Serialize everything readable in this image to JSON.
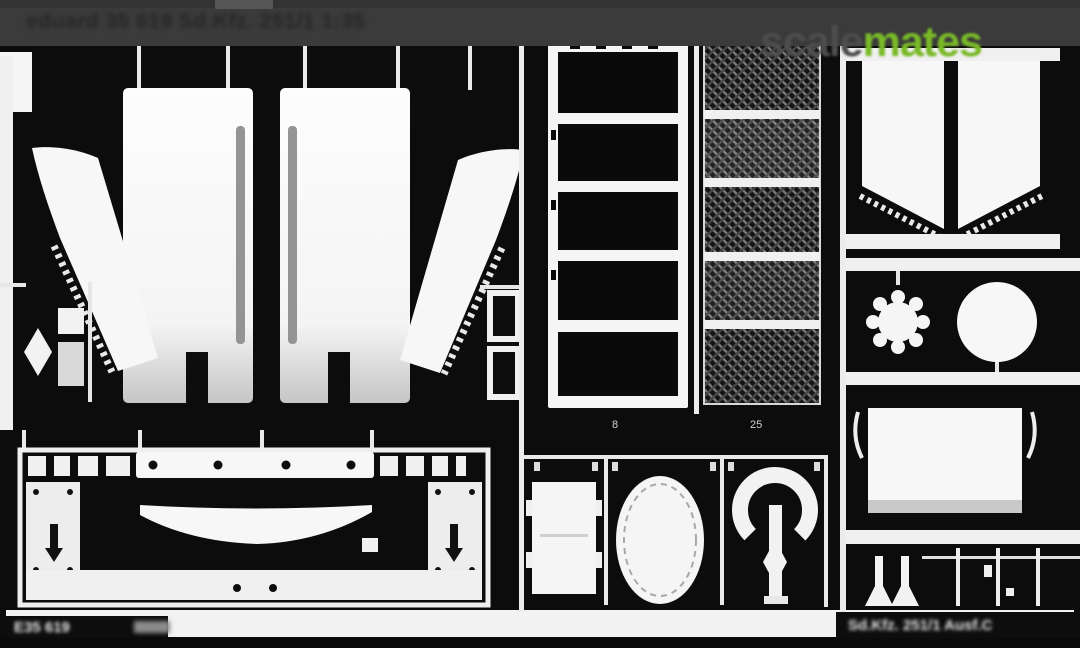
{
  "image_type": "scan of a photo-etched model detail fret on black background",
  "colors": {
    "background": "#0c0c0c",
    "header_band": "#3b3b3b",
    "metal_parts": "#f5f5f5",
    "watermark_scale": "#4d4d4d",
    "watermark_mates": "#79b928",
    "bottom_band": "#f2f2f2"
  },
  "watermark": {
    "part1": "scale",
    "part2": "mates"
  },
  "header": {
    "title": "eduard 35 619 Sd.Kfz. 251/1 1:35"
  },
  "footer": {
    "left_code": "E35 619",
    "right_text": "Sd.Kfz. 251/1 Ausf.C"
  },
  "part_marks": {
    "below_ladder": "8",
    "below_mesh": "25"
  }
}
